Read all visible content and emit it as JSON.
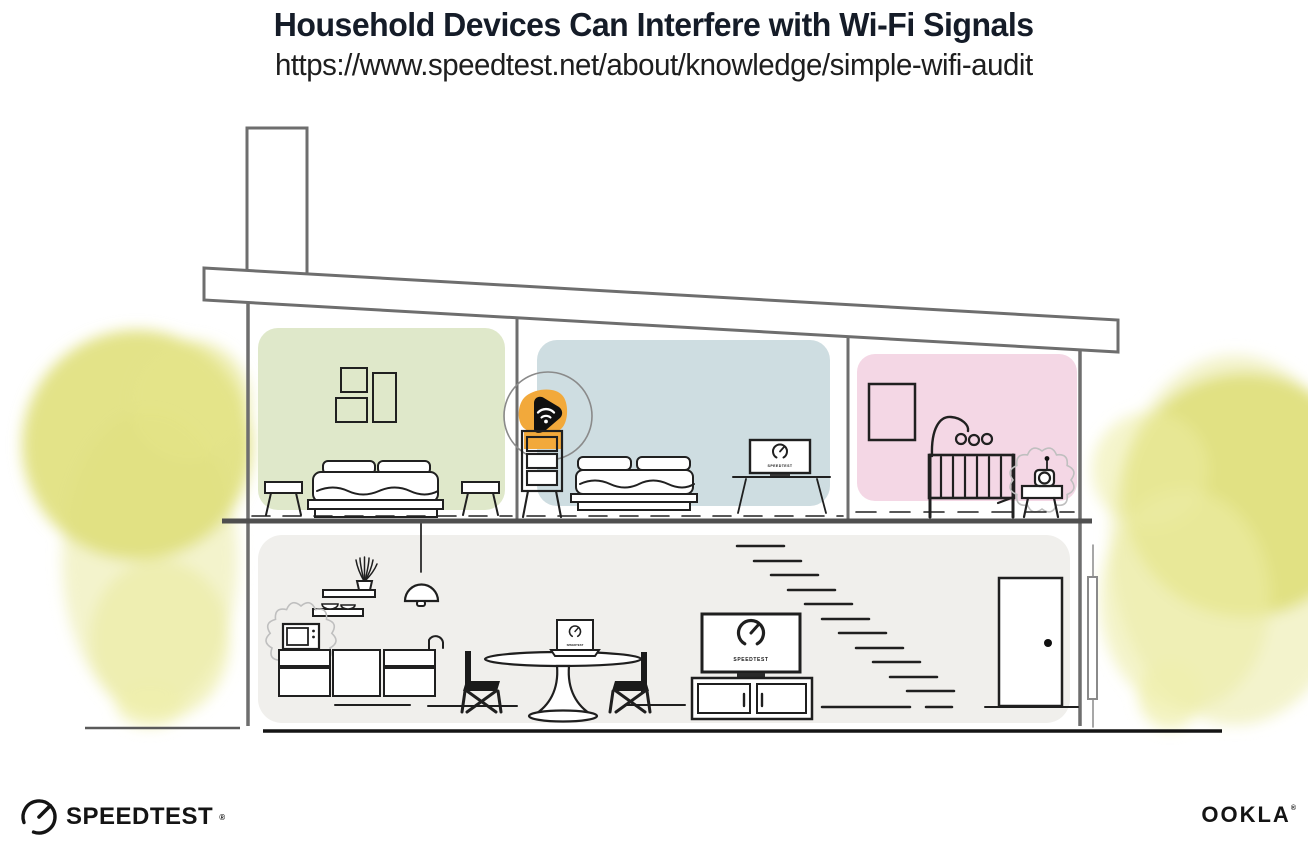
{
  "header": {
    "title": "Household Devices Can Interfere with Wi-Fi Signals",
    "url": "https://www.speedtest.net/about/knowledge/simple-wifi-audit"
  },
  "branding": {
    "speedtest": {
      "label": "SPEEDTEST",
      "trademark": "®"
    },
    "ookla": {
      "label": "OOKLA",
      "trademark": "®"
    }
  },
  "illustration": {
    "screen_label": "SPEEDTEST",
    "rooms": {
      "bedroom_left": {
        "name": "bedroom-green",
        "color": "#dfe8ca"
      },
      "bedroom_middle": {
        "name": "bedroom-blue",
        "color": "#cedde1"
      },
      "nursery": {
        "name": "nursery-pink",
        "color": "#f4d7e5"
      },
      "living_area": {
        "name": "living-kitchen",
        "color": "#f0efec"
      }
    },
    "devices": {
      "router": {
        "name": "wifi-router",
        "highlight_color": "#f2a93b"
      },
      "microwave": {
        "name": "microwave-interference-source"
      },
      "baby_monitor": {
        "name": "baby-monitor-interference-source"
      },
      "tv_bedroom": {
        "name": "tv-running-speedtest"
      },
      "tv_living": {
        "name": "tv-running-speedtest"
      },
      "laptop": {
        "name": "laptop-running-speedtest"
      }
    },
    "foliage_color": "#e0e07c",
    "structure_color": "#6e6e6e"
  }
}
